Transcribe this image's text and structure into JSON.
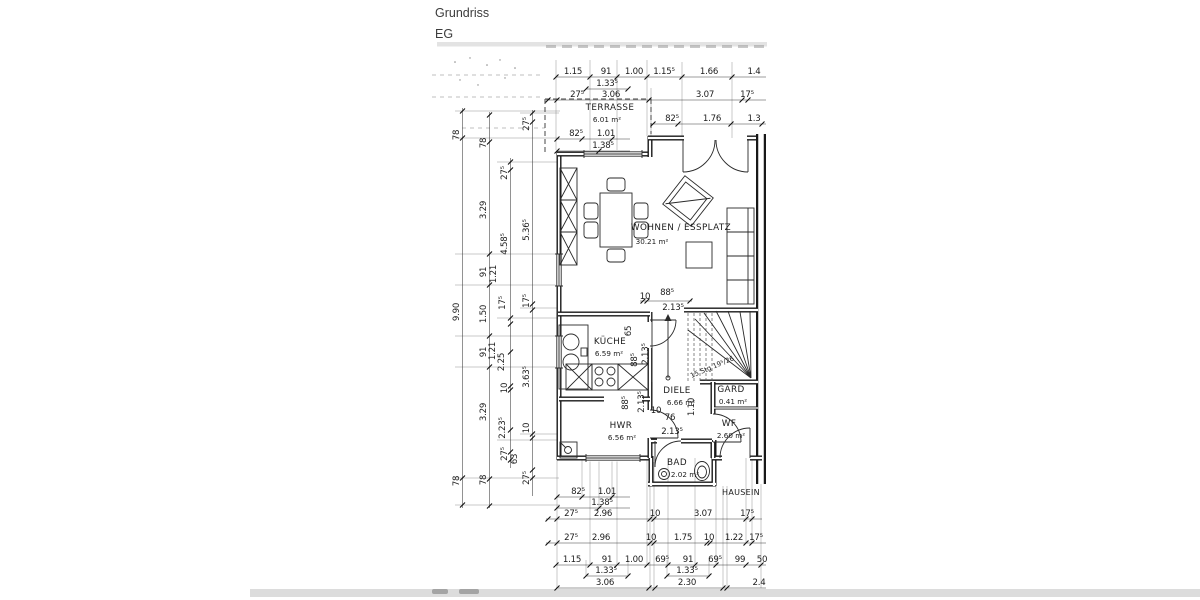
{
  "header": {
    "title": "Grundriss",
    "floor": "EG"
  },
  "rooms": [
    {
      "name": "TERRASSE",
      "area": "6.01 m²"
    },
    {
      "name": "WOHNEN / ESSPLATZ",
      "area": "30.21 m²"
    },
    {
      "name": "KÜCHE",
      "area": "6.59 m²"
    },
    {
      "name": "HWR",
      "area": "6.56 m²"
    },
    {
      "name": "DIELE",
      "area": "6.66 m²"
    },
    {
      "name": "GARD",
      "area": "0.41 m²"
    },
    {
      "name": "WF",
      "area": "2.60 m²"
    },
    {
      "name": "BAD",
      "area": "2.02 m²"
    }
  ],
  "stairs_note": "15 Stg 19⁵/26",
  "entrance_label": "HAUSEIN",
  "dims": {
    "top_row1": [
      "1.15",
      "91",
      "1.00",
      "1.15⁵",
      "1.66",
      "1.4"
    ],
    "top_row1b": [
      "1.33⁵"
    ],
    "top_row2": [
      "27⁵",
      "3.06",
      "3.07",
      "17⁵"
    ],
    "terrace_door_row": [
      "82⁵",
      "1.76",
      "1.3"
    ],
    "terrace_win_row": [
      "82⁵",
      "1.01"
    ],
    "terrace_win_row2": [
      "1.38⁵"
    ],
    "left_chain_outer": [
      "78",
      "9.90",
      "78"
    ],
    "left_chain_2": [
      "78",
      "3.29",
      "91",
      "1.50",
      "91",
      "3.29",
      "78"
    ],
    "left_chain_3": [
      "27⁵",
      "4.58⁵",
      "1.21",
      "17⁵",
      "1.21",
      "2.25",
      "10",
      "2.23⁵",
      "27⁵",
      "63"
    ],
    "left_chain_4": [
      "27⁵",
      "5.36⁵",
      "17⁵",
      "3.63⁵",
      "10",
      "27⁵"
    ],
    "bottom_row1": [
      "82⁵",
      "1.01"
    ],
    "bottom_row1b": [
      "1.38⁵"
    ],
    "bottom_row2": [
      "27⁵",
      "2.96",
      "10",
      "3.07",
      "17⁵"
    ],
    "bottom_row3": [
      "27⁵",
      "2.96",
      "10",
      "1.75",
      "10",
      "1.22",
      "17⁵"
    ],
    "bottom_row4": [
      "1.15",
      "91",
      "1.00",
      "69⁵",
      "91",
      "69⁵",
      "99",
      "50"
    ],
    "bottom_row4b": [
      "1.33⁵",
      "1.33⁵"
    ],
    "bottom_row5": [
      "3.06",
      "2.30",
      "2.4"
    ],
    "inner": [
      "10",
      "88⁵",
      "2.13⁵",
      "65",
      "88⁵",
      "2.13⁵",
      "88⁵",
      "2.13⁵",
      "10",
      "76",
      "2.13⁵",
      "1.10"
    ]
  }
}
